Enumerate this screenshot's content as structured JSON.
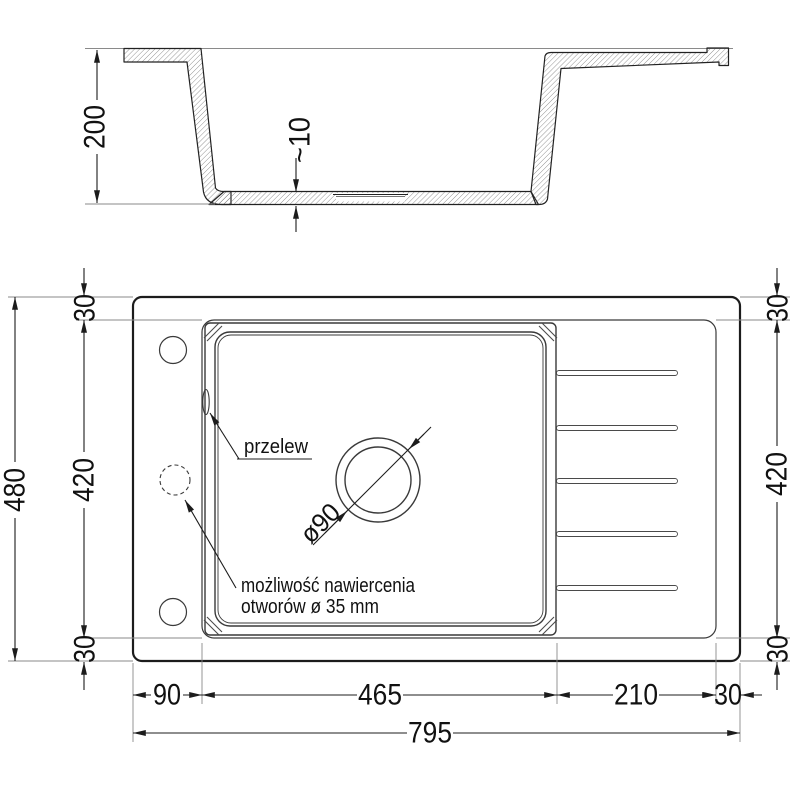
{
  "drawing": {
    "section": {
      "height": "200",
      "bottom_thickness": "~10"
    },
    "plan": {
      "left": {
        "total": "480",
        "inner": "420",
        "top": "30",
        "bottom": "30"
      },
      "right": {
        "top": "30",
        "inner": "420",
        "bottom": "30"
      },
      "bottom": {
        "deck": "90",
        "bowl": "465",
        "drainer": "210",
        "edge": "30",
        "total": "795"
      },
      "notes": {
        "overflow": "przelew",
        "drill_line1": "możliwość nawiercenia",
        "drill_line2": "otworów ø 35 mm",
        "drain_diameter": "ø90"
      }
    },
    "colors": {
      "line": "#1c1c1c",
      "thin_line": "#8a8a8a",
      "text": "#111111",
      "background": "#ffffff"
    }
  }
}
